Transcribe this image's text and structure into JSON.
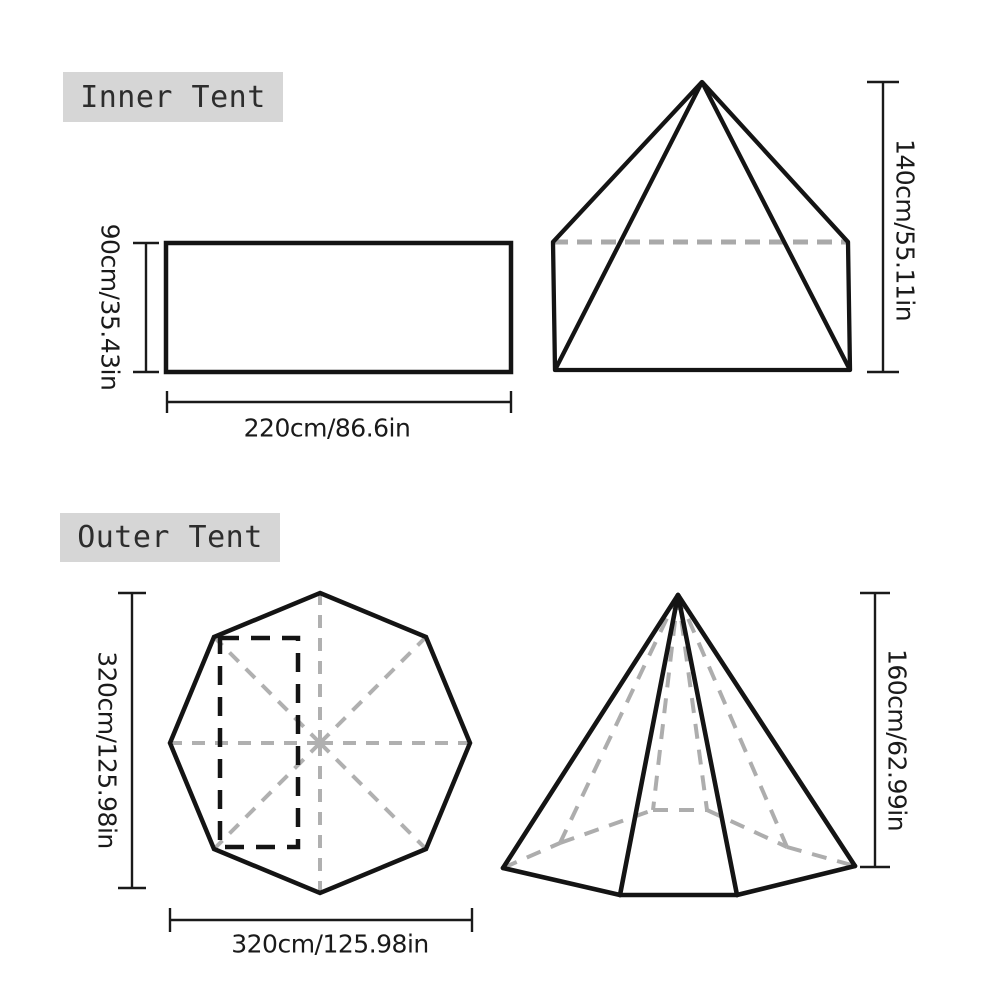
{
  "colors": {
    "ink": "#141414",
    "dim_line": "#1a1a1a",
    "dashed_gray": "#aaaaaa",
    "label_background": "#d6d6d6",
    "label_text": "#2d2d2d",
    "background": "#ffffff"
  },
  "inner_tent": {
    "title": "Inner Tent",
    "floor_plan": {
      "depth_label": "90cm/35.43in",
      "width_label": "220cm/86.6in"
    },
    "side_view": {
      "height_label": "140cm/55.11in"
    }
  },
  "outer_tent": {
    "title": "Outer Tent",
    "floor_plan": {
      "diameter_vertical_label": "320cm/125.98in",
      "diameter_horizontal_label": "320cm/125.98in"
    },
    "side_view": {
      "height_label": "160cm/62.99in"
    }
  }
}
